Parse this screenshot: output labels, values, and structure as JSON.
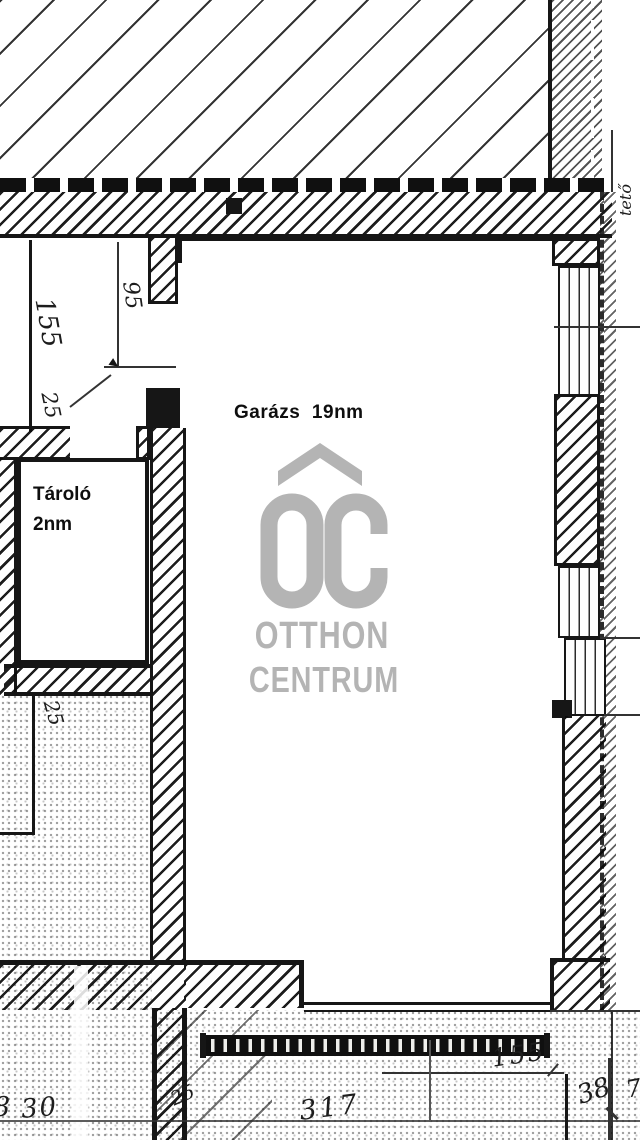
{
  "rooms": {
    "garage_label": "Garázs  19nm",
    "storage_name": "Tároló",
    "storage_area": "2nm"
  },
  "watermark": {
    "monogram_letter_o": "O",
    "monogram_letter_c": "C",
    "brand_line1": "OTTHON",
    "brand_line2": "CENTRUM",
    "color": "#b4b4b4"
  },
  "dimensions": {
    "left_wall_155": "155",
    "left_opening_95": "95",
    "left_wall_25": "25",
    "lower_left_25": "25",
    "bottom_partial_8": "8",
    "bottom_30": "30",
    "bottom_pier_25": "25",
    "bottom_317": "317",
    "garage_door_155": "155",
    "bottom_right_38": "38",
    "bottom_right_7": "7",
    "right_margin_note": "tető"
  },
  "colors": {
    "ink": "#161616",
    "paper": "#ffffff",
    "watermark_gray": "#b4b4b4"
  }
}
